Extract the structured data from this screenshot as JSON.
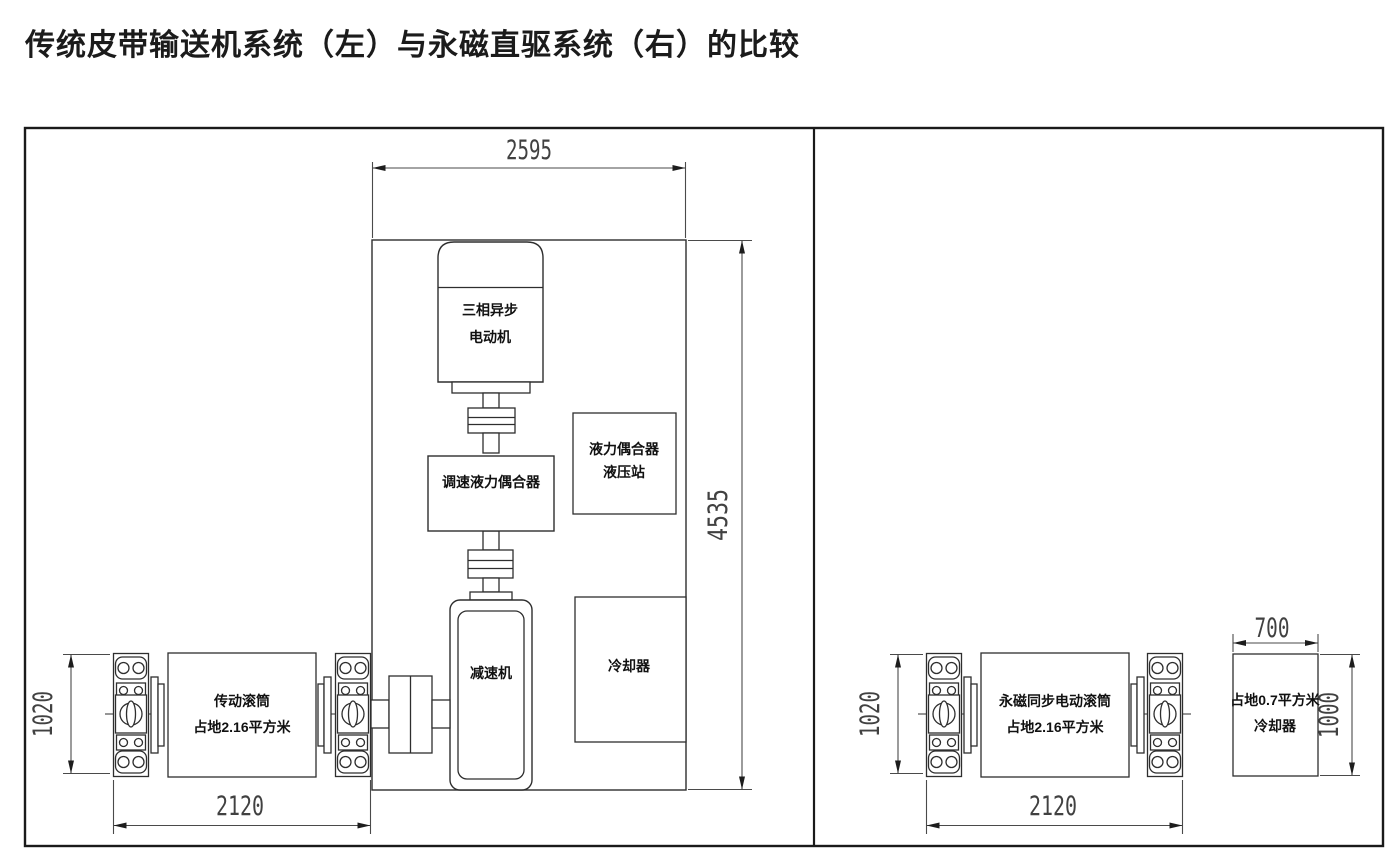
{
  "title": "传统皮带输送机系统（左）与永磁直驱系统（右）的比较",
  "left_system": {
    "enclosure_width_dim": "2595",
    "enclosure_height_dim": "4535",
    "motor_label_line1": "三相异步",
    "motor_label_line2": "电动机",
    "speed_coupling_label": "调速液力偶合器",
    "hydraulic_station_line1": "液力偶合器",
    "hydraulic_station_line2": "液压站",
    "gearbox_label": "减速机",
    "cooler_label": "冷却器",
    "drum_label_line1": "传动滚筒",
    "drum_label_line2": "占地2.16平方米",
    "drum_height_dim": "1020",
    "drum_width_dim": "2120"
  },
  "right_system": {
    "drum_label_line1": "永磁同步电动滚筒",
    "drum_label_line2": "占地2.16平方米",
    "drum_height_dim": "1020",
    "drum_width_dim": "2120",
    "cooler_label_line1": "占地0.7平方米",
    "cooler_label_line2": "冷却器",
    "cooler_width_dim": "700",
    "cooler_height_dim": "1000"
  },
  "colors": {
    "background": "#ffffff",
    "line": "#2e2e2e",
    "border": "#1a1a1a",
    "dim_line": "#4a4a4a",
    "dim_text": "#414141",
    "label_text": "#111111"
  }
}
